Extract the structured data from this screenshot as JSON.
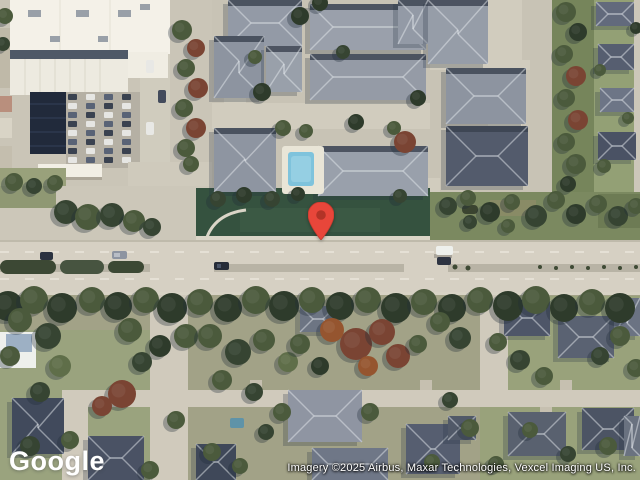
{
  "map": {
    "view_type": "satellite",
    "logo_text": "Google",
    "attribution_text": "Imagery ©2025 Airbus, Maxar Technologies, Vexcel Imaging US, Inc.",
    "marker": {
      "color": "#E8463A",
      "inner_color": "#B23327",
      "screen_x": 321,
      "screen_y": 240
    }
  }
}
